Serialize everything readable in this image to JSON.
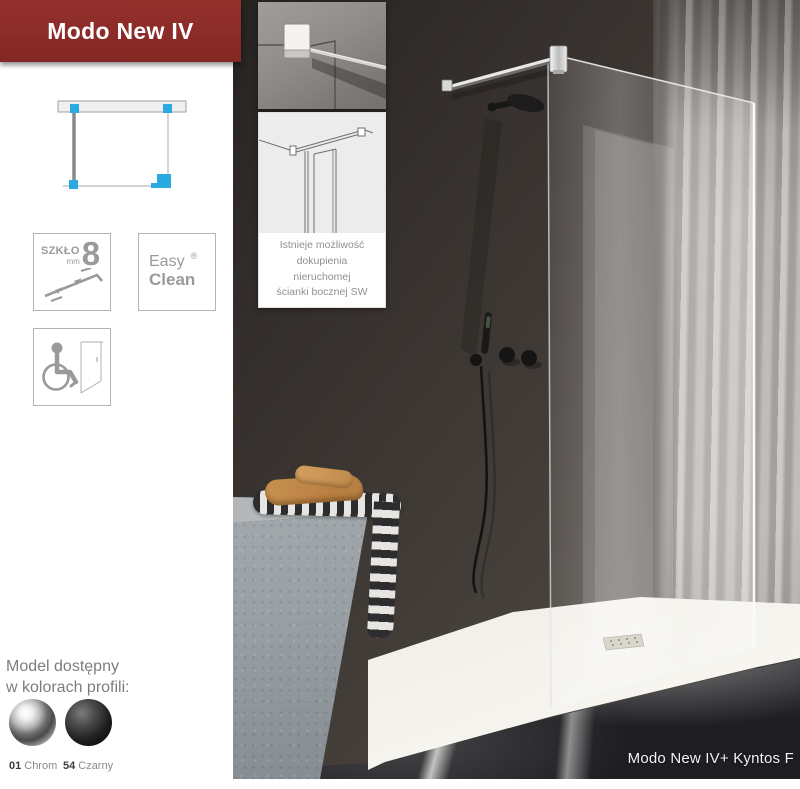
{
  "page": {
    "title_banner": "Modo New IV"
  },
  "badges": {
    "glass": {
      "label": "SZKŁO",
      "unit": "mm",
      "value": "8"
    },
    "easy_clean": {
      "line1": "Easy",
      "line2": "Clean",
      "registered": "®"
    }
  },
  "note": {
    "lines": [
      "Istnieje możliwość",
      "dokupienia",
      "nieruchomej",
      "ścianki bocznej SW"
    ]
  },
  "profiles": {
    "heading_line1": "Model dostępny",
    "heading_line2": "w kolorach profili:",
    "options": [
      {
        "code": "01",
        "name": "Chrom",
        "color": "#b9b9b9"
      },
      {
        "code": "54",
        "name": "Czarny",
        "color": "#1a1a1a"
      }
    ]
  },
  "photo": {
    "caption": "Modo New IV+ Kyntos F"
  },
  "colors": {
    "banner_red": "#8C2B28",
    "accent_blue": "#29ABE2",
    "icon_gray": "#9A9A9A"
  }
}
